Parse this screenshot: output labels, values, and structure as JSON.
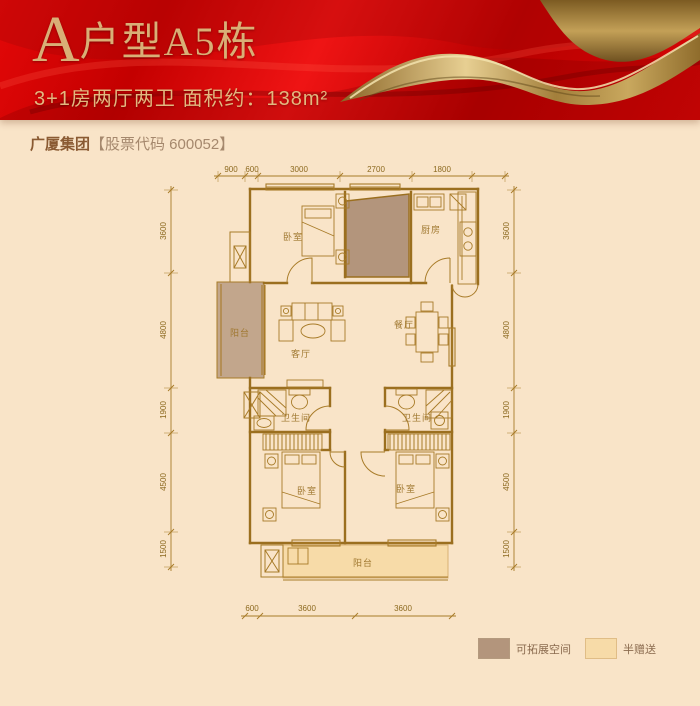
{
  "banner": {
    "letter": "A",
    "title": "户型A5栋",
    "subtitle": "3+1房两厅两卫 面积约：138m²"
  },
  "brand": {
    "bold": "广厦集团",
    "rest": "【股票代码 600052】"
  },
  "floorplan": {
    "rooms": {
      "bedroom_top": "卧室",
      "kitchen": "厨房",
      "balcony_left": "阳台",
      "living": "客厅",
      "dining": "餐厅",
      "bath_left": "卫生间",
      "bath_right": "卫生间",
      "bedroom_left": "卧室",
      "bedroom_right": "卧室",
      "balcony_bottom": "阳台"
    },
    "dims": {
      "top": [
        "900",
        "600",
        "3000",
        "2700",
        "1800"
      ],
      "left": [
        "3600",
        "4800",
        "1900",
        "4500",
        "1500"
      ],
      "right": [
        "3600",
        "4800",
        "1900",
        "4500",
        "1500"
      ],
      "bottom": [
        "600",
        "3600",
        "3600"
      ]
    }
  },
  "legend": {
    "items": [
      {
        "label": "可拓展空间",
        "color": "#b3957c"
      },
      {
        "label": "半赠送",
        "color": "#f7dba8"
      }
    ]
  },
  "colors": {
    "background": "#f9e4c8",
    "banner_red": "#cf0404",
    "banner_gold": "#d9af76",
    "plan_line": "#a87b28",
    "expandable_fill": "#b3957c",
    "bonus_fill": "#f7dba8"
  }
}
